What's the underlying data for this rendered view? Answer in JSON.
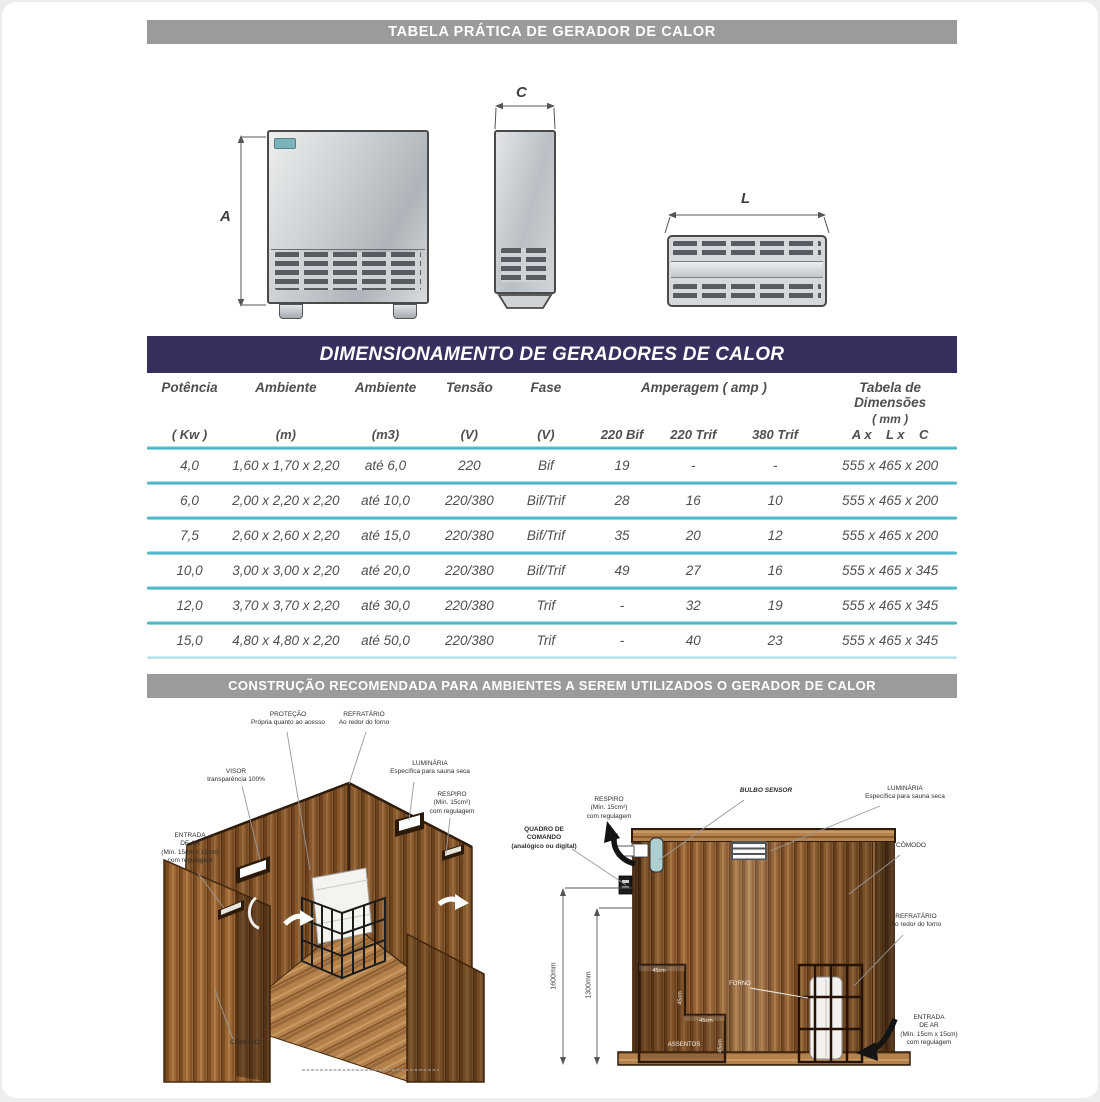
{
  "banners": {
    "top": "TABELA PRÁTICA DE GERADOR DE CALOR",
    "dimensioning": "DIMENSIONAMENTO DE GERADORES DE CALOR",
    "construction": "CONSTRUÇÃO RECOMENDADA PARA AMBIENTES A SEREM UTILIZADOS O GERADOR DE CALOR"
  },
  "colors": {
    "banner_gray": "#9b9b9b",
    "banner_purple": "#37305f",
    "separator_teal": "#45b4c5",
    "wood_mid": "#9a6636",
    "badge_teal": "#7ab3ba"
  },
  "drawings": {
    "dim_a": "A",
    "dim_c": "C",
    "dim_l": "L"
  },
  "table": {
    "headers": {
      "potencia_l1": "Potência",
      "potencia_l2": "( Kw )",
      "ambiente_m_l1": "Ambiente",
      "ambiente_m_l2": "(m)",
      "ambiente_m3_l1": "Ambiente",
      "ambiente_m3_l2": "(m3)",
      "tensao_l1": "Tensão",
      "tensao_l2": "(V)",
      "fase_l1": "Fase",
      "fase_l2": "(V)",
      "amperagem_group": "Amperagem ( amp )",
      "amp_220bif": "220 Bif",
      "amp_220trif": "220 Trif",
      "amp_380trif": "380 Trif",
      "dim_l1": "Tabela de Dimensões",
      "dim_l2": "( mm )",
      "dim_l3": "A x    L x    C"
    },
    "rows": [
      {
        "potencia": "4,0",
        "ambiente_m": "1,60 x 1,70 x 2,20",
        "ambiente_m3": "até 6,0",
        "tensao": "220",
        "fase": "Bif",
        "a220bif": "19",
        "a220trif": "-",
        "a380trif": "-",
        "dimensoes": "555 x 465 x 200"
      },
      {
        "potencia": "6,0",
        "ambiente_m": "2,00 x 2,20 x 2,20",
        "ambiente_m3": "até 10,0",
        "tensao": "220/380",
        "fase": "Bif/Trif",
        "a220bif": "28",
        "a220trif": "16",
        "a380trif": "10",
        "dimensoes": "555 x 465 x 200"
      },
      {
        "potencia": "7,5",
        "ambiente_m": "2,60 x 2,60 x 2,20",
        "ambiente_m3": "até 15,0",
        "tensao": "220/380",
        "fase": "Bif/Trif",
        "a220bif": "35",
        "a220trif": "20",
        "a380trif": "12",
        "dimensoes": "555 x 465 x 200"
      },
      {
        "potencia": "10,0",
        "ambiente_m": "3,00 x 3,00 x 2,20",
        "ambiente_m3": "até 20,0",
        "tensao": "220/380",
        "fase": "Bif/Trif",
        "a220bif": "49",
        "a220trif": "27",
        "a380trif": "16",
        "dimensoes": "555 x 465 x 345"
      },
      {
        "potencia": "12,0",
        "ambiente_m": "3,70 x 3,70 x 2,20",
        "ambiente_m3": "até 30,0",
        "tensao": "220/380",
        "fase": "Trif",
        "a220bif": "-",
        "a220trif": "32",
        "a380trif": "19",
        "dimensoes": "555 x 465 x 345"
      },
      {
        "potencia": "15,0",
        "ambiente_m": "4,80 x 4,80 x 2,20",
        "ambiente_m3": "até 50,0",
        "tensao": "220/380",
        "fase": "Trif",
        "a220bif": "-",
        "a220trif": "40",
        "a380trif": "23",
        "dimensoes": "555 x 465 x 345"
      }
    ]
  },
  "illustration_left": {
    "labels": {
      "protecao": "PROTEÇÃO\nPrópria quanto ao acesso",
      "refratario": "REFRATÁRIO\nAo redor do forno",
      "visor": "VISOR\ntransparência 100%",
      "luminaria": "LUMINÁRIA\nEspecífica para sauna seca",
      "respiro": "RESPIRO\n(Mín. 15cm²)\ncom regulagem",
      "entrada_ar": "ENTRADA\nDE AR\n(Mín. 15cm x 15cm)\ncom regulagem",
      "comodo": "CÔMODO"
    }
  },
  "illustration_right": {
    "labels": {
      "respiro": "RESPIRO\n(Mín. 15cm²)\ncom regulagem",
      "bulbo_sensor": "BULBO SENSOR",
      "quadro_comando": "QUADRO DE\nCOMANDO\n(analógico ou digital)",
      "luminaria": "LUMINÁRIA\nEspecífica para sauna seca",
      "comodo": "CÔMODO",
      "refratario": "REFRATÁRIO\nAo redor do forno",
      "entrada_ar": "ENTRADA\nDE AR\n(Mín. 15cm x 15cm)\ncom regulagem",
      "forno": "FORNO",
      "assentos": "ASSENTOS",
      "dim_height_total": "1600mm",
      "dim_height_bench": "1300mm",
      "bench_dims": [
        "45cm",
        "45cm",
        "45cm",
        "45cm"
      ]
    }
  }
}
